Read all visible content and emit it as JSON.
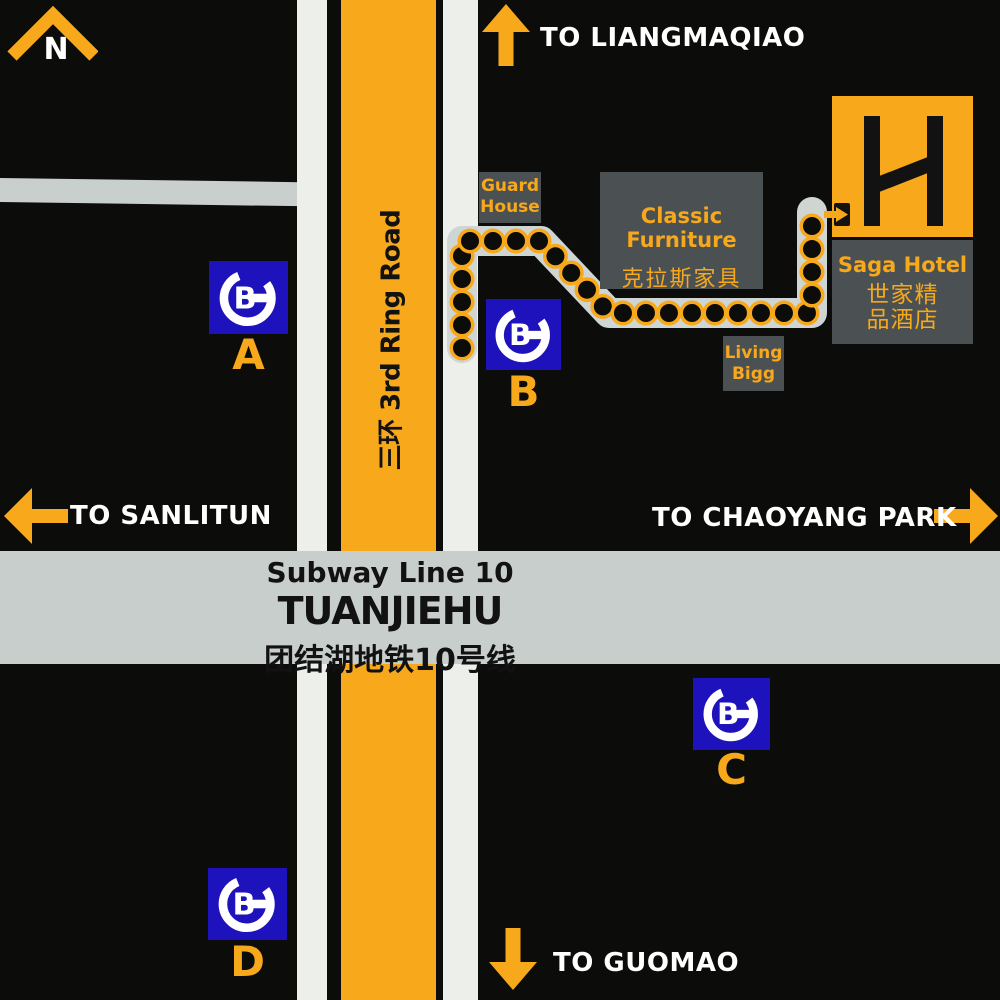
{
  "colors": {
    "yellow": "#F7A81B",
    "metro_blue": "#1D12BC",
    "panel_gray": "#4B5152",
    "band_gray": "#C8CECC",
    "sidewalk_gray": "#EDEFEB",
    "walkway_gray": "#CFD5D2",
    "left_road_gray": "#C9CFCD",
    "background": "#0C0C0B",
    "text_white": "#FFFFFF",
    "text_black": "#121212"
  },
  "compass": {
    "label": "N"
  },
  "directions": {
    "north": {
      "label": "TO LIANGMAQIAO"
    },
    "west": {
      "label": "TO SANLITUN"
    },
    "east": {
      "label": "TO CHAOYANG PARK"
    },
    "south": {
      "label": "TO GUOMAO"
    }
  },
  "ring_road": {
    "label": "三环  3rd Ring Road"
  },
  "station": {
    "line": "Subway Line 10",
    "name": "TUANJIEHU",
    "name_cn": "团结湖地铁10号线"
  },
  "buildings": {
    "guard_house": {
      "line1": "Guard",
      "line2": "House"
    },
    "classic_furniture": {
      "name": "Classic Furniture",
      "name_cn": "克拉斯家具"
    },
    "living_bigg": {
      "line1": "Living",
      "line2": "Bigg"
    },
    "hotel": {
      "logo_letter": "H",
      "name": "Saga Hotel",
      "cn_line1": "世家精",
      "cn_line2": "品酒店"
    }
  },
  "exits": [
    {
      "label": "A"
    },
    {
      "label": "B"
    },
    {
      "label": "C"
    },
    {
      "label": "D"
    }
  ],
  "walk_path": {
    "points": [
      [
        462,
        348
      ],
      [
        462,
        241
      ],
      [
        541,
        241
      ],
      [
        609,
        313
      ],
      [
        812,
        313
      ],
      [
        812,
        212
      ]
    ],
    "dot_spacing": 23,
    "dot_outer_radius": 12.5,
    "dot_inner_radius": 9,
    "stroke_width": 30
  }
}
